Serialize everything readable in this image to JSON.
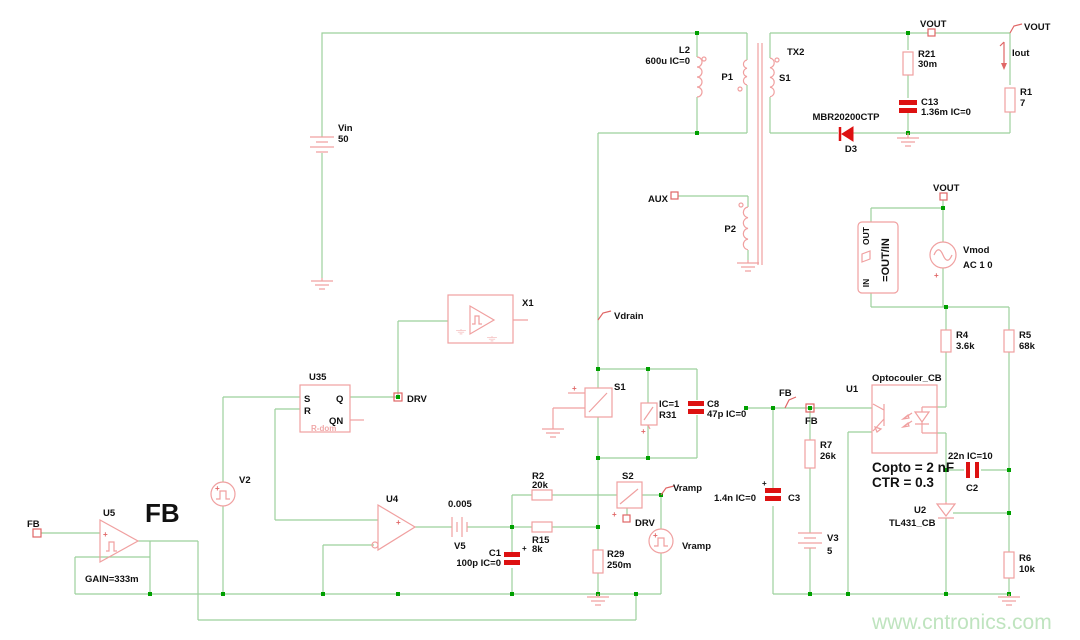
{
  "watermark": "www.cntronics.com",
  "colors": {
    "wire": "#9cd09c",
    "junction": "#00a000",
    "component": "#f0a0a0",
    "highlight_red": "#dd1111",
    "flag_red": "#e06666",
    "text": "#111111",
    "watermark": "#bfe4bf",
    "background": "#ffffff"
  },
  "labels": {
    "plus": "+",
    "vin_name": "Vin",
    "vin_value": "50",
    "l2_name": "L2",
    "l2_value": "600u IC=0",
    "p1": "P1",
    "p2": "P2",
    "tx2": "TX2",
    "s1_winding": "S1",
    "aux": "AUX",
    "vout_top": "VOUT",
    "vout_right": "VOUT",
    "vout_mid": "VOUT",
    "iout": "Iout",
    "r21_name": "R21",
    "r21_value": "30m",
    "c13_name": "C13",
    "c13_value": "1.36m IC=0",
    "r1_name": "R1",
    "r1_value": "7",
    "d3_part": "MBR20200CTP",
    "d3_name": "D3",
    "vmod_name": "Vmod",
    "vmod_value": "AC 1 0",
    "outin_out": "OUT",
    "outin_in": "IN",
    "outin_eq": "=OUT/IN",
    "r4_name": "R4",
    "r4_value": "3.6k",
    "r5_name": "R5",
    "r5_value": "68k",
    "vdrain": "Vdrain",
    "x1": "X1",
    "u35_name": "U35",
    "u35_s": "S",
    "u35_r": "R",
    "u35_q": "Q",
    "u35_qn": "QN",
    "u35_rdom": "R-dom",
    "drv_node": "DRV",
    "drv_flag": "DRV",
    "s1_switch": "S1",
    "s2_name": "S2",
    "r31_ic": "IC=1",
    "r31_name": "R31",
    "c8_name": "C8",
    "c8_value": "47p IC=0",
    "v2_name": "V2",
    "u5_name": "U5",
    "fb_big": "FB",
    "fb_port": "FB",
    "gain": "GAIN=333m",
    "u4_name": "U4",
    "v5_value": "0.005",
    "v5_name": "V5",
    "c1_name": "C1",
    "c1_value": "100p IC=0",
    "r15_name": "R15",
    "r15_value": "8k",
    "r2_name": "R2",
    "r2_value": "20k",
    "vramp_flag": "Vramp",
    "vramp_src": "Vramp",
    "r29_name": "R29",
    "r29_value": "250m",
    "fb_flag": "FB",
    "fb_node": "FB",
    "c3_name": "C3",
    "c3_value": "1.4n IC=0",
    "r7_name": "R7",
    "r7_value": "26k",
    "v3_name": "V3",
    "v3_value": "5",
    "u1_name": "U1",
    "opto_name": "Optocouler_CB",
    "copto": "Copto = 2 nF",
    "ctr": "CTR = 0.3",
    "c2_name": "C2",
    "c2_value": "22n IC=10",
    "u2_name": "U2",
    "u2_part": "TL431_CB",
    "r6_name": "R6",
    "r6_value": "10k"
  }
}
